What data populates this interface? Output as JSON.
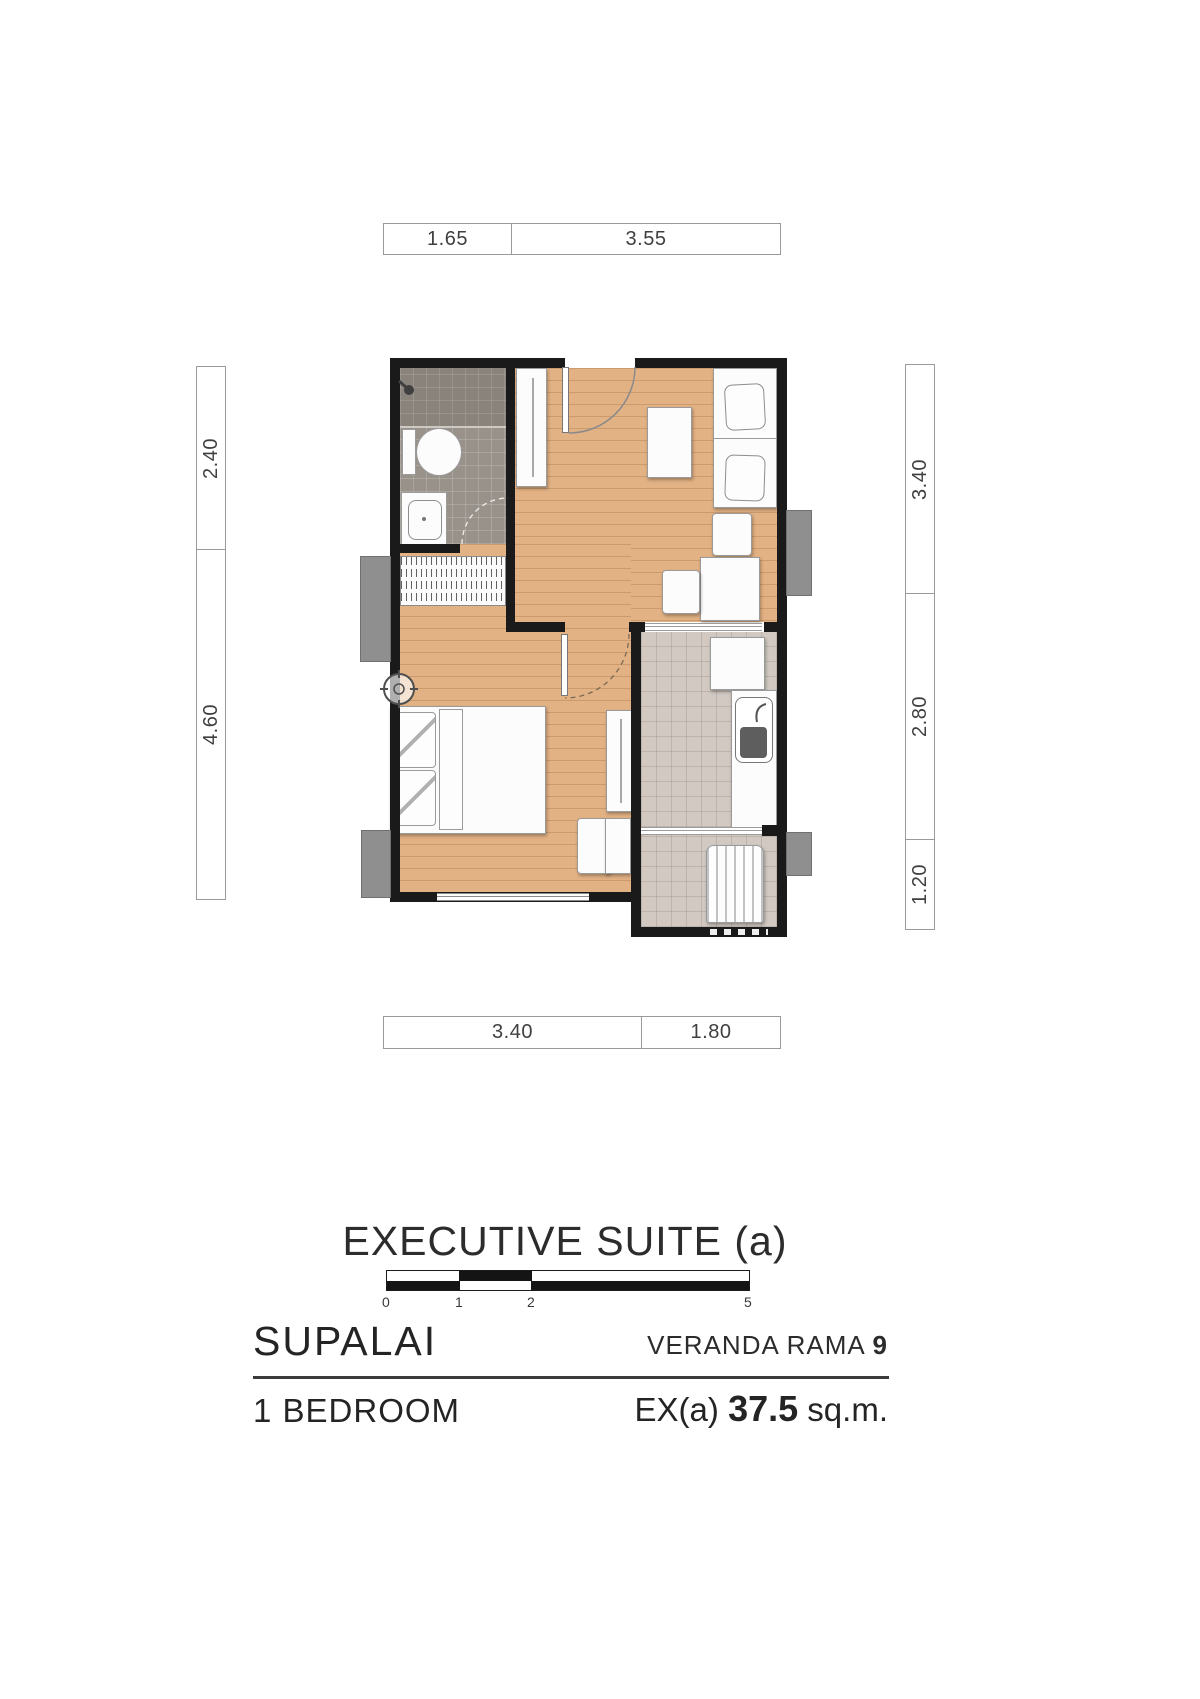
{
  "title": "EXECUTIVE SUITE (a)",
  "dimensions": {
    "top": [
      "1.65",
      "3.55"
    ],
    "bottom": [
      "3.40",
      "1.80"
    ],
    "left": [
      "2.40",
      "4.60"
    ],
    "right": [
      "3.40",
      "2.80",
      "1.20"
    ]
  },
  "scale_bar": {
    "labels": [
      "0",
      "1",
      "2",
      "5"
    ]
  },
  "footer": {
    "brand": "SUPALAI",
    "project_name": "VERANDA RAMA ",
    "project_number": "9",
    "unit_type": "1 BEDROOM",
    "area_code": "EX(a) ",
    "area_value": "37.5",
    "area_unit": " sq.m."
  },
  "colors": {
    "wall": "#1a1a1a",
    "wood_floor": "#e2b284",
    "bathroom_tile": "#99928b",
    "kitchen_tile": "#d1c9c2",
    "ledge_gray": "#8f8f8f"
  }
}
